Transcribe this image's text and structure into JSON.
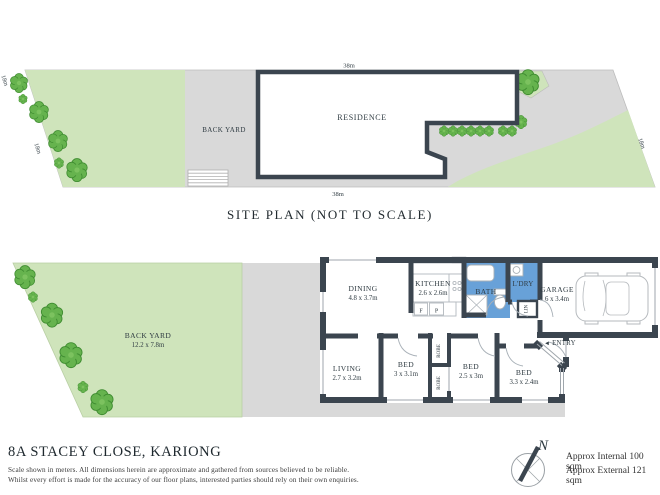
{
  "colors": {
    "wall": "#3b454f",
    "wet_area_blue": "#68a1d8",
    "window_blue": "#cfe0f0",
    "lawn_green": "#cfe4bb",
    "tree_green": "#66b34e",
    "paving_gray": "#d9d9d9",
    "text": "#2f3b42"
  },
  "site_plan": {
    "title": "SITE PLAN (NOT TO SCALE)",
    "residence": "RESIDENCE",
    "back_yard": "BACK YARD",
    "dim_top": "38m",
    "dim_bottom": "38m",
    "dim_left": "18m",
    "dim_right": "18m"
  },
  "floor_plan": {
    "back_yard": {
      "name": "BACK YARD",
      "dims": "12.2 x 7.8m"
    },
    "rooms": {
      "dining": {
        "name": "DINING",
        "dims": "4.8 x 3.7m"
      },
      "kitchen": {
        "name": "KITCHEN",
        "dims": "2.6 x 2.6m"
      },
      "bath": {
        "name": "BATH"
      },
      "laundry": {
        "name": "L'DRY"
      },
      "garage": {
        "name": "GARAGE",
        "dims": "6 x 3.4m"
      },
      "living": {
        "name": "LIVING",
        "dims": "2.7 x 3.2m"
      },
      "bed1": {
        "name": "BED",
        "dims": "3 x 3.1m"
      },
      "bed2": {
        "name": "BED",
        "dims": "2.5 x 3m"
      },
      "bed3": {
        "name": "BED",
        "dims": "3.3 x 2.4m"
      }
    },
    "labels": {
      "robe": "ROBE",
      "linen": "LIN",
      "entry": "ENTRY",
      "entry_arrow": "◄",
      "fridge": "F",
      "pantry": "P"
    }
  },
  "footer": {
    "address": "8A STACEY CLOSE, KARIONG",
    "disclaimer_line1": "Scale shown in meters. All dimensions herein are approximate and gathered from sources believed to be reliable.",
    "disclaimer_line2": "Whilst every effort is made for the accuracy of our floor plans, interested parties should rely on their own enquiries.",
    "compass_n": "N",
    "approx_internal": "Approx Internal 100 sqm",
    "approx_external": "Approx External 121 sqm"
  }
}
